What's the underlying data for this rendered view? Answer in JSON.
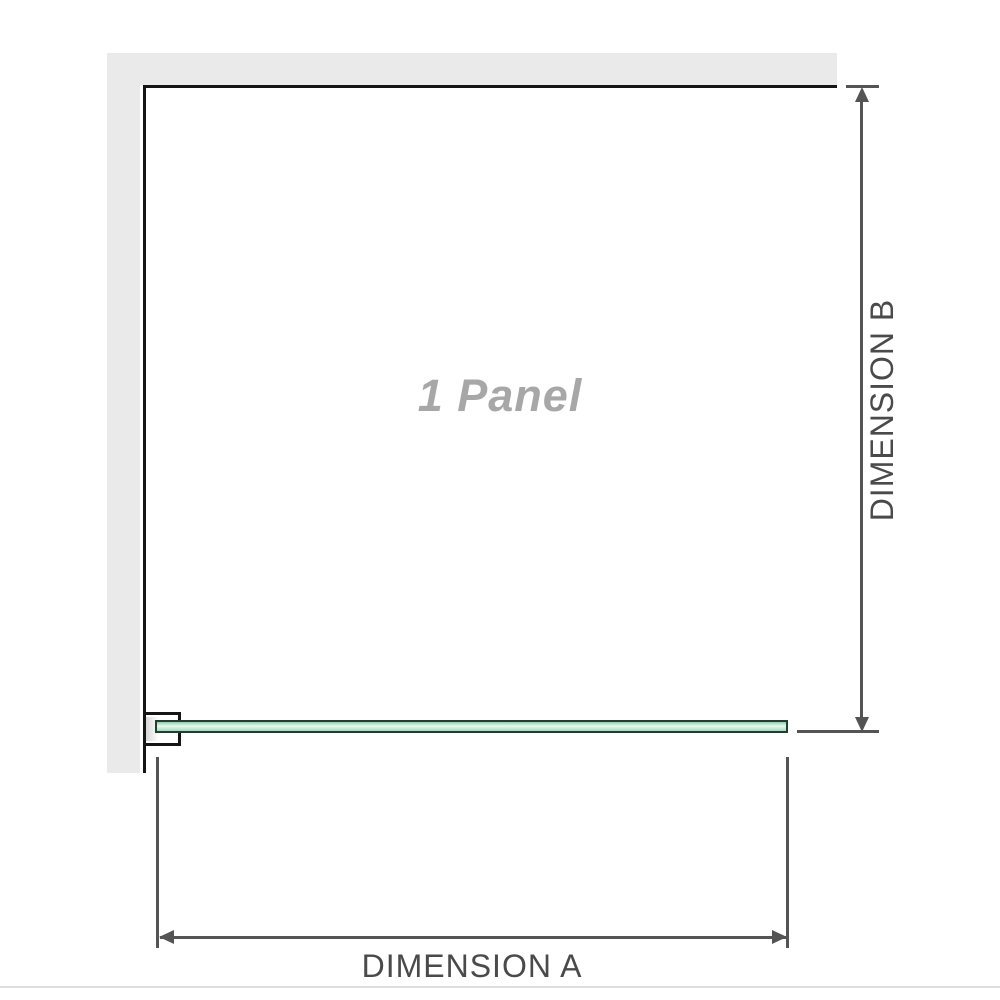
{
  "diagram": {
    "panel_label": "1 Panel",
    "dimension_a": {
      "label": "DIMENSION A"
    },
    "dimension_b": {
      "label": "DIMENSION B"
    }
  },
  "colors": {
    "wall": "#eaeaea",
    "outline": "#151515",
    "line": "#545454",
    "label": "#4a4a4a",
    "panel_label": "#a7a7a7",
    "glass_border": "#1d4030",
    "glass_top": "#8bcfa9",
    "glass_light": "#e9f7f0",
    "glass_mid": "#c3e9d5",
    "glass_bottom": "#9edbbc",
    "bracket_shade": "#d7d7d7",
    "baseline": "#dedede"
  }
}
